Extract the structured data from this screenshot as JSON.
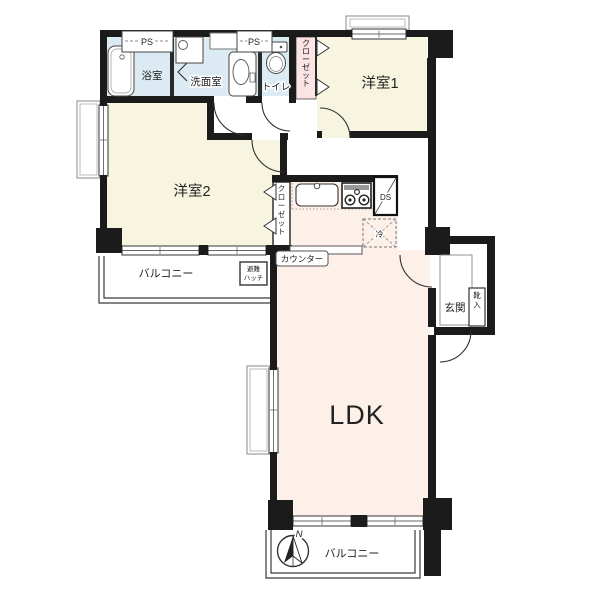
{
  "plan": {
    "rooms": {
      "bath": "浴室",
      "washroom": "洗面室",
      "toilet": "トイレ",
      "bedroom1": "洋室1",
      "bedroom2": "洋室2",
      "ldk": "LDK",
      "entrance": "玄関"
    },
    "labels": {
      "ps1": "PS",
      "ps2": "PS",
      "ds": "DS",
      "fridge": "冷",
      "closet_bedroom1": "クローゼット",
      "closet_bedroom2": "クローゼット",
      "shoe_cabinet": "靴入",
      "counter": "カウンター",
      "hatch_line1": "避難",
      "hatch_line2": "ハッチ",
      "balcony_left": "バルコニー",
      "balcony_bottom": "バルコニー",
      "north": "N"
    },
    "colors": {
      "wall": "#1b1b1b",
      "wet_area": "#dcebf3",
      "bedroom": "#f7f5e0",
      "ldk": "#fdf0e8",
      "closet_pink": "#fbe4e4",
      "white": "#ffffff"
    }
  }
}
